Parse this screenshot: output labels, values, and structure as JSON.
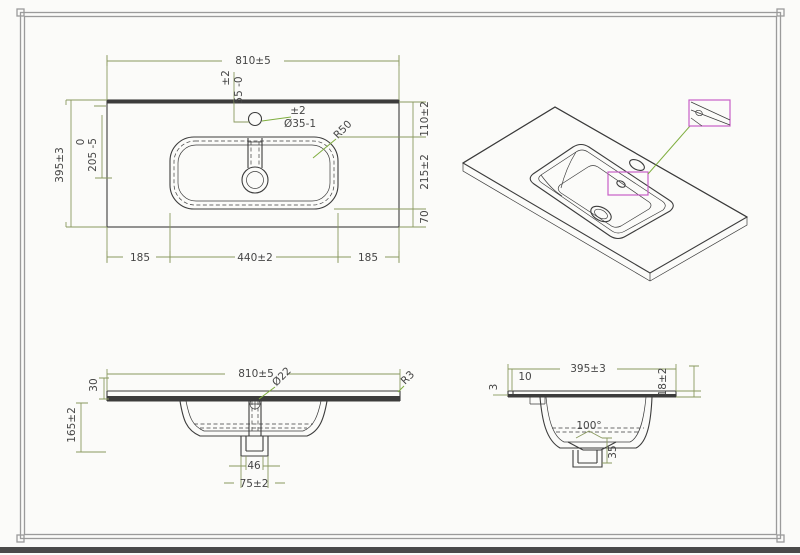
{
  "drawing": {
    "title": "washbasin-technical-drawing",
    "colors": {
      "paper": "#fbfbf9",
      "line": "#3c3c3c",
      "dim": "#8a9a5f",
      "leader": "#7fae3f",
      "accent": "#c75fc7",
      "frame": "#9b9b9b",
      "footer": "#4a4a4a"
    },
    "views": {
      "plan": {
        "dims": {
          "width": "810±5",
          "faucet_tol": "±2",
          "faucet_offset": "55 -0",
          "hole_tol": "±2",
          "hole_dia": "Ø35-1",
          "corner_radius": "R50",
          "depth": "395±3",
          "basin_tol": "0",
          "basin_offset": "205 -5",
          "back_edge": "110±2",
          "basin_depth": "215±2",
          "front_edge": "70",
          "left_margin": "185",
          "basin_width": "440±2",
          "right_margin": "185"
        }
      },
      "front": {
        "dims": {
          "width": "810±5",
          "drain_dia": "Ø22",
          "edge_radius": "R3",
          "apron": "30",
          "height": "165±2",
          "drain_inner": "46",
          "drain_outer": "75±2"
        }
      },
      "side": {
        "dims": {
          "depth": "395±3",
          "ledge": "10",
          "lip": "3",
          "edge_thickness": "18±2",
          "bowl_angle": "100°",
          "drain_depth": "35"
        }
      }
    }
  }
}
